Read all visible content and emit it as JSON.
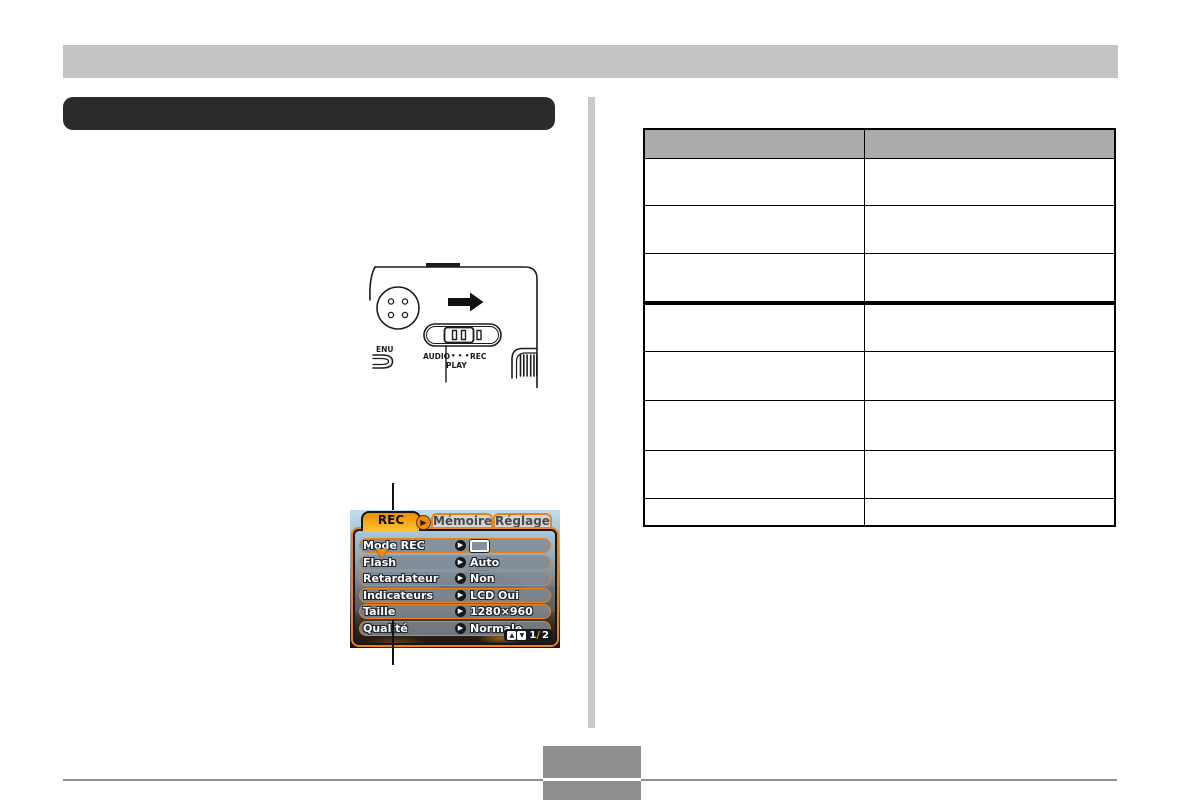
{
  "colors": {
    "header_bar": "#c4c4c4",
    "title_bar": "#2b2b2b",
    "divider": "#c9c9c9",
    "table_header_bg": "#ababab",
    "table_border": "#000000",
    "footer_gray": "#8f8f8f",
    "lcd_orange": "#e8821e",
    "rec_tab_orange": "#ef8e00"
  },
  "camera": {
    "labels": {
      "audio": "AUDIO",
      "dots": "• • •",
      "rec": "REC",
      "play": "PLAY",
      "menu_partial": "ENU"
    }
  },
  "lcd": {
    "icons": {
      "right_arrow": "▶"
    },
    "tabs": [
      {
        "label": "REC",
        "active": true
      },
      {
        "label": "Mémoire",
        "active": false
      },
      {
        "label": "Réglage",
        "active": false
      }
    ],
    "menu_items": [
      {
        "label": "Mode REC",
        "value": ""
      },
      {
        "label": "Flash",
        "value": "Auto"
      },
      {
        "label": "Retardateur",
        "value": "Non"
      },
      {
        "label": "Indicateurs",
        "value": "LCD Oui"
      },
      {
        "label": "Taille",
        "value": "1280×960"
      },
      {
        "label": "Qualité",
        "value": "Normale"
      }
    ],
    "pager": {
      "up": "▲",
      "down": "▼",
      "current": "1",
      "separator": "/",
      "total": "2"
    }
  },
  "table": {
    "headers": [
      "",
      ""
    ],
    "rows": [
      [
        "",
        ""
      ],
      [
        "",
        ""
      ],
      [
        "",
        ""
      ],
      [
        "",
        ""
      ],
      [
        "",
        ""
      ],
      [
        "",
        ""
      ],
      [
        "",
        ""
      ],
      [
        "",
        ""
      ]
    ]
  },
  "footer": {
    "page_number": ""
  }
}
